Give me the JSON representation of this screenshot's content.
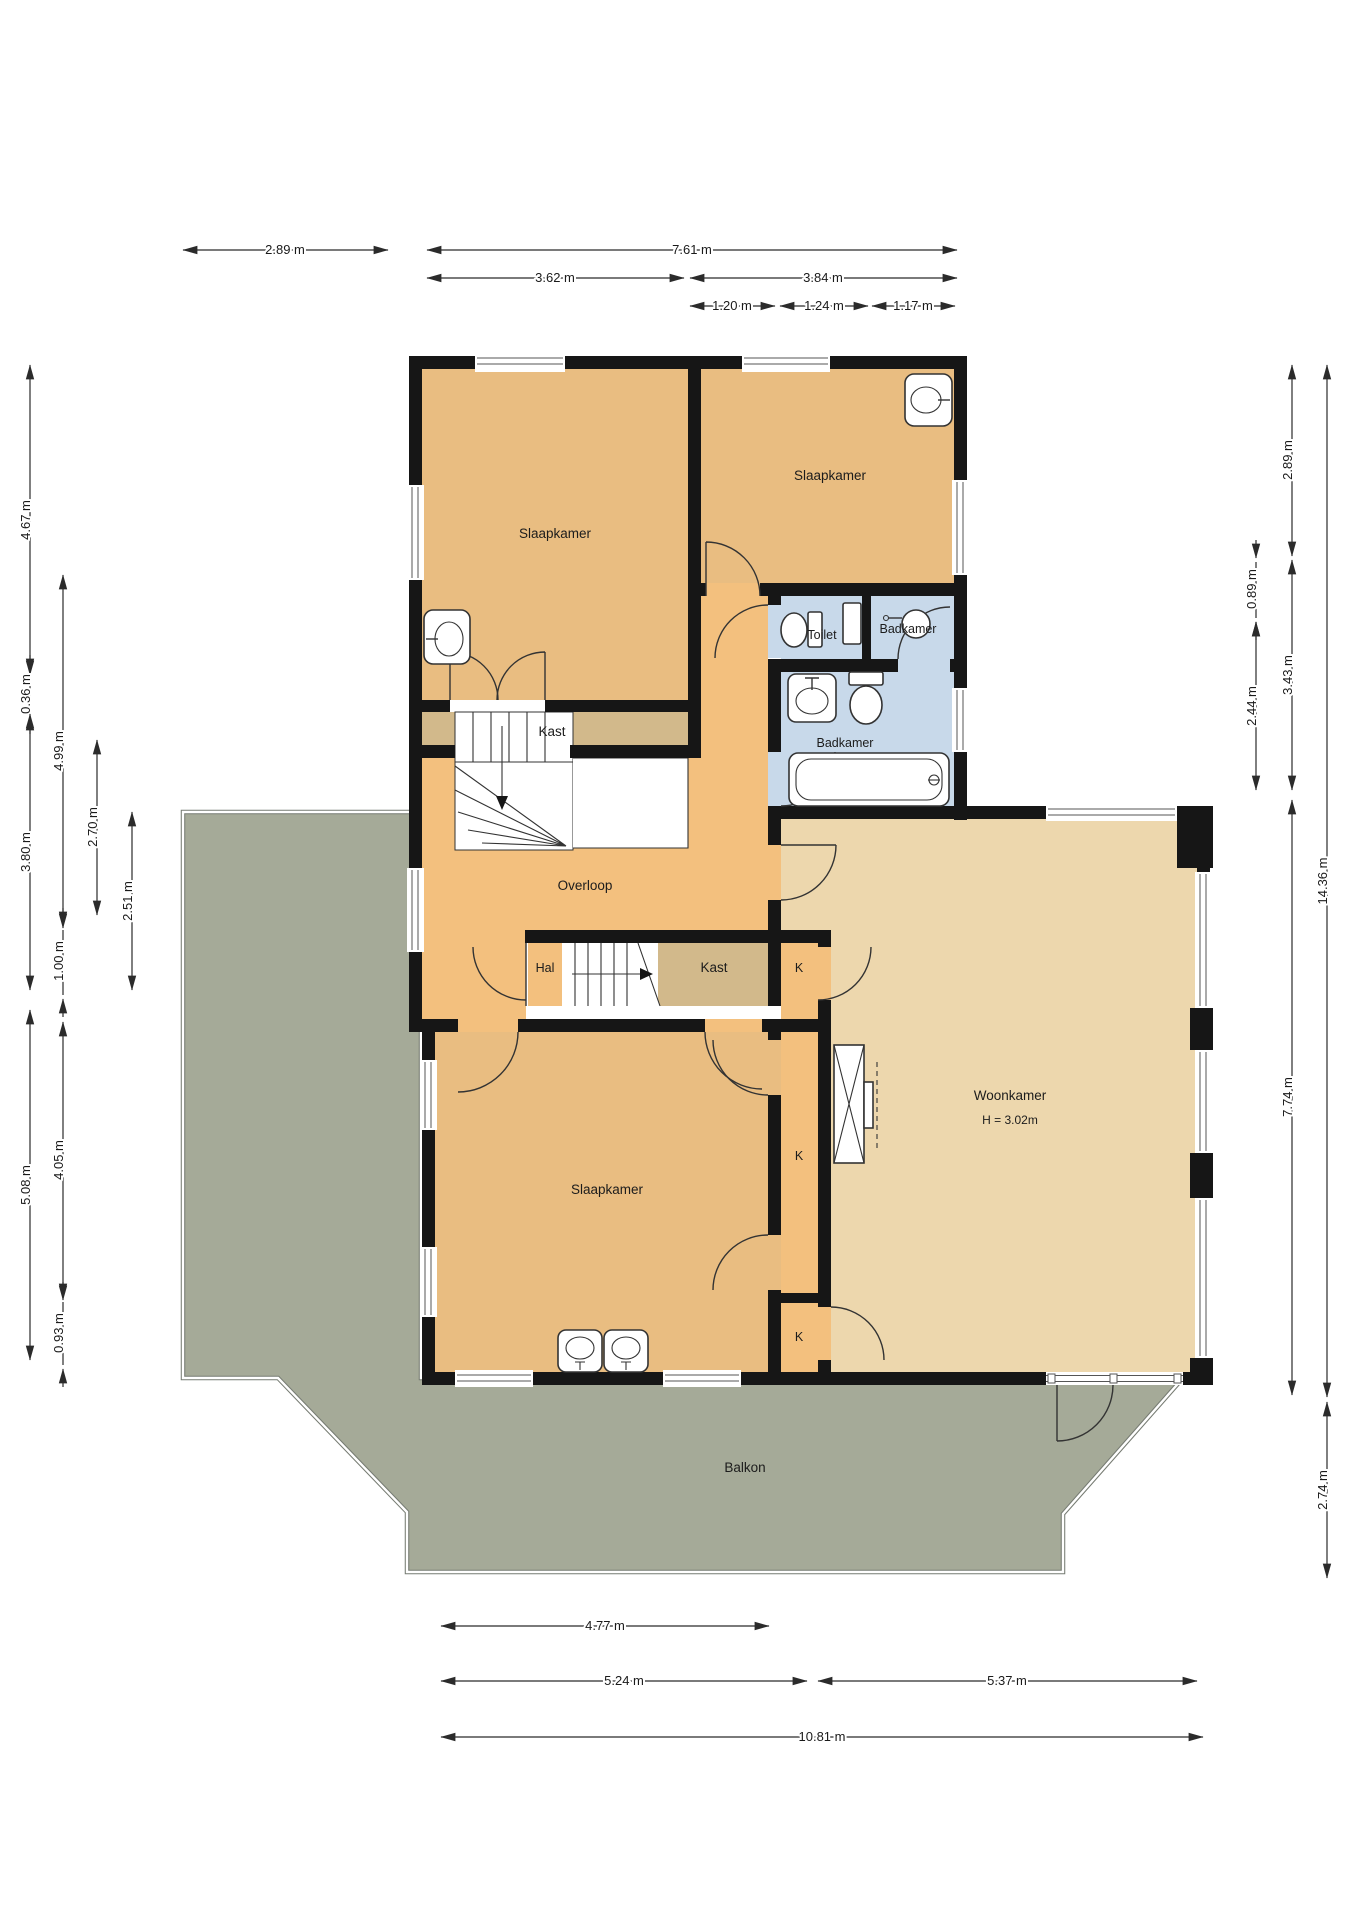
{
  "labels": {
    "bedroom_top_left": "Slaapkamer",
    "bedroom_top_right": "Slaapkamer",
    "toilet": "Toilet",
    "bathroom_small": "Badkamer",
    "bathroom_main": "Badkamer",
    "closet_top": "Kast",
    "landing": "Overloop",
    "hall": "Hal",
    "closet_mid": "Kast",
    "closet_k1": "K",
    "closet_k2": "K",
    "closet_k3": "K",
    "living_room": "Woonkamer",
    "living_room_height": "H = 3.02m",
    "bedroom_bottom": "Slaapkamer",
    "balcony": "Balkon"
  },
  "dimensions": {
    "top_row1": [
      "2.89 m",
      "7.61 m"
    ],
    "top_row2": [
      "3.62 m",
      "3.84 m"
    ],
    "top_row3": [
      "1.20 m",
      "1.24 m",
      "1.17 m"
    ],
    "left_col_outer": [
      "4.67 m",
      "0.36 m",
      "3.80 m",
      "5.08 m"
    ],
    "left_col2": [
      "4.99 m",
      "1.00 m",
      "4.05 m",
      "0.93 m"
    ],
    "left_col3": [
      "2.70 m"
    ],
    "left_col4": [
      "2.51 m"
    ],
    "right_col_inner": [
      "0.89 m",
      "2.44 m"
    ],
    "right_col2": [
      "2.89 m",
      "3.43 m",
      "7.74 m"
    ],
    "right_col_outer": [
      "14.36 m",
      "2.74 m"
    ],
    "bottom_row1": [
      "4.77 m"
    ],
    "bottom_row2": [
      "5.24 m",
      "5.37 m"
    ],
    "bottom_row3": [
      "10.81 m"
    ]
  },
  "colors": {
    "bedroom": "#e9bd81",
    "circulation": "#f3c07e",
    "living": "#edd7ad",
    "closet": "#d2b98b",
    "bathroom": "#c8d9ea",
    "balcony": "#a5aa98",
    "wall": "#161616"
  }
}
